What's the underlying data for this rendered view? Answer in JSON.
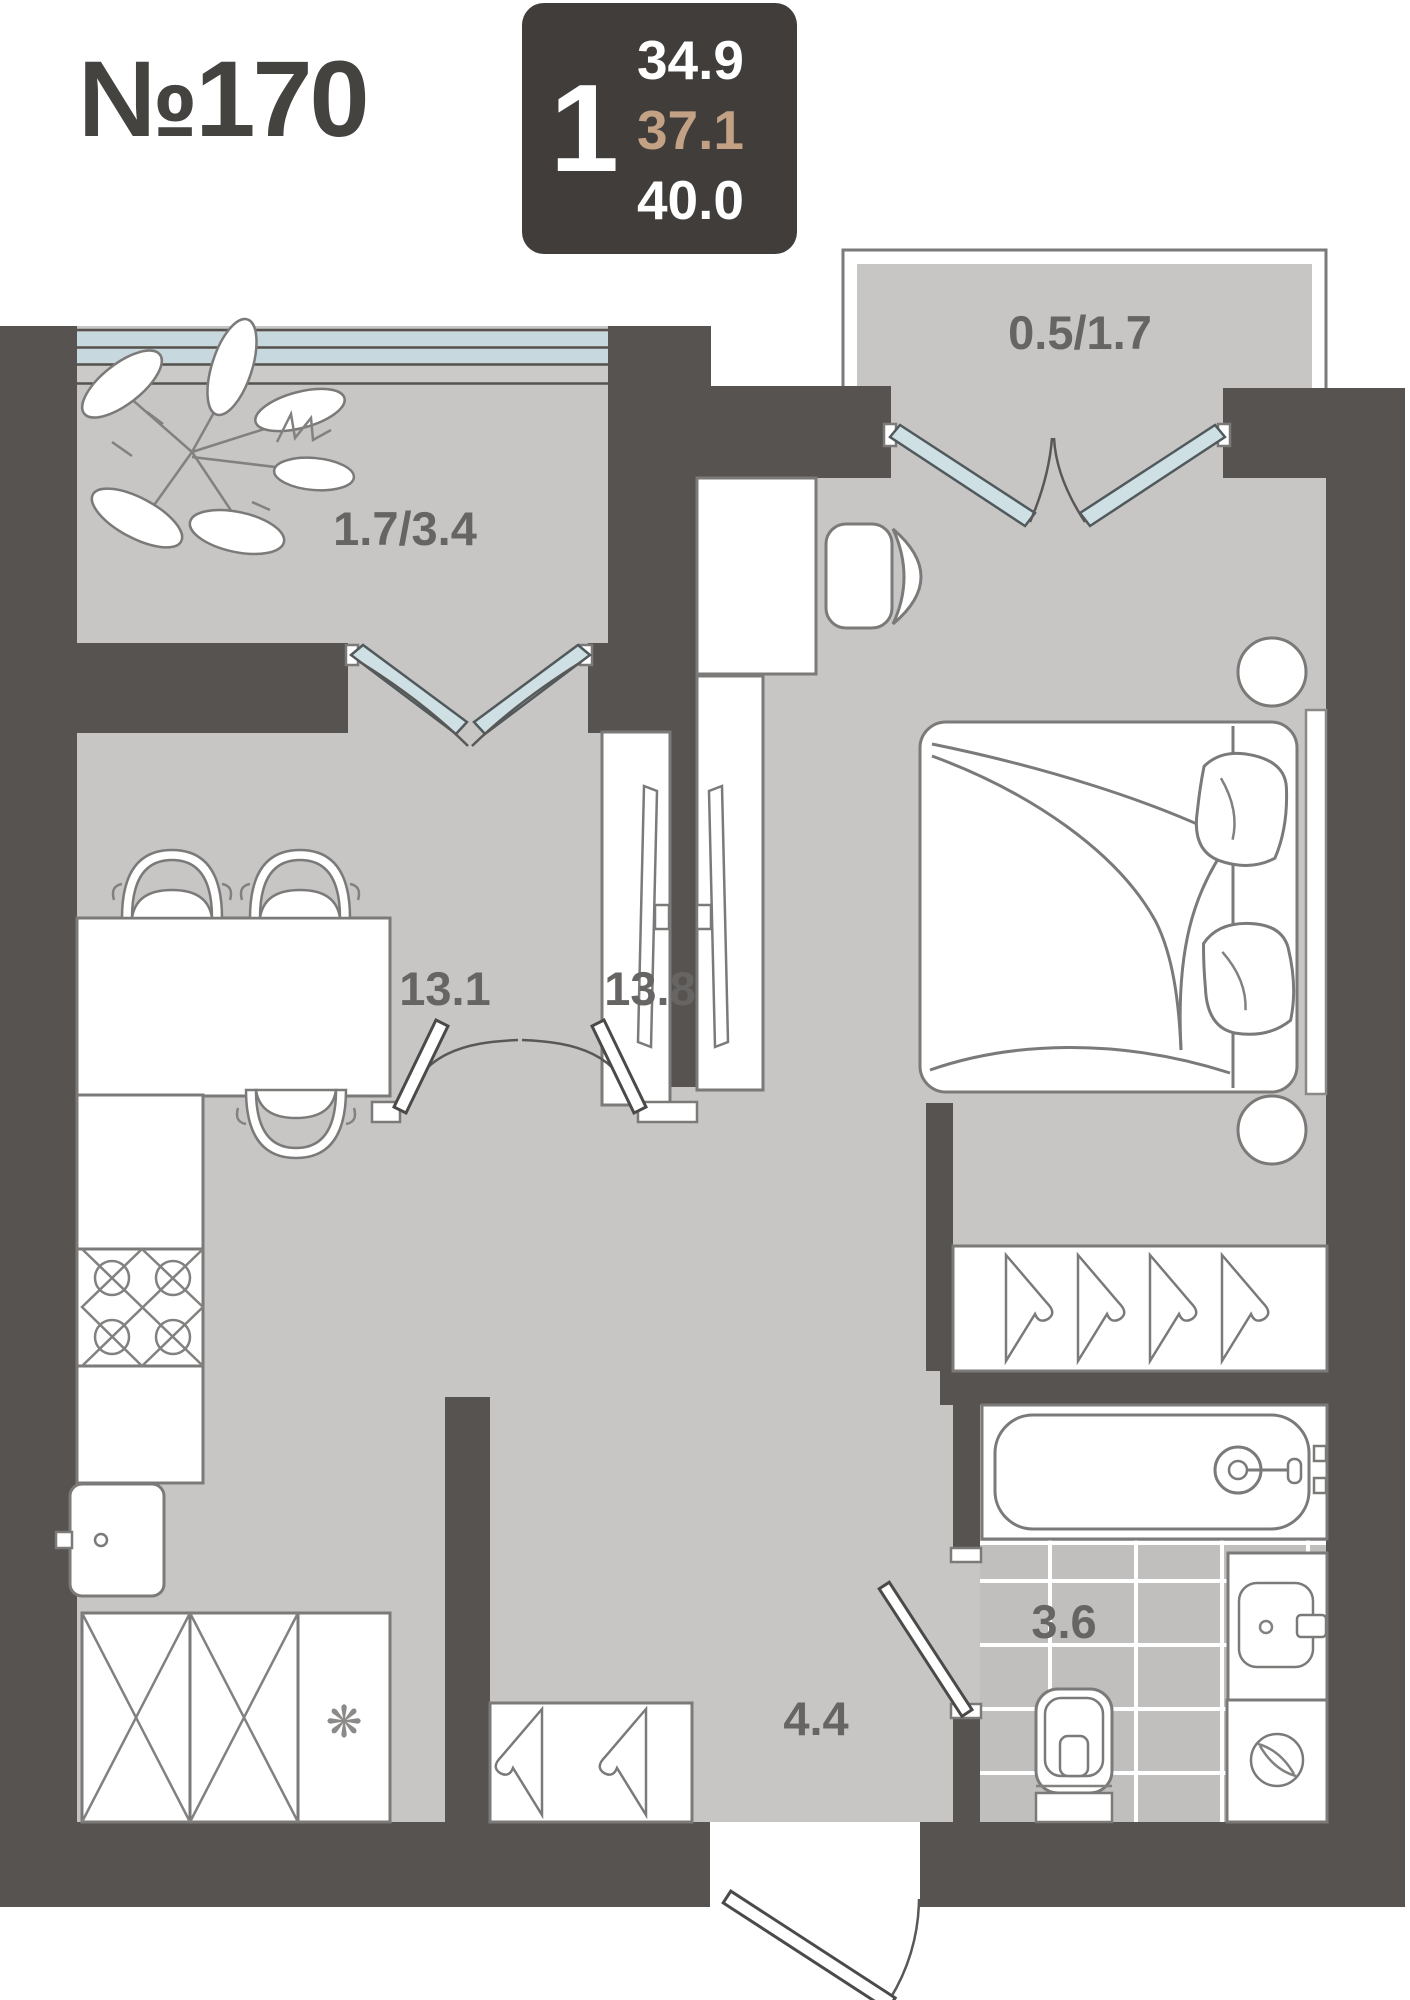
{
  "header": {
    "apartment_number": "№170",
    "badge": {
      "rooms_count": "1",
      "area_living": "34.9",
      "area_planned": "37.1",
      "area_total": "40.0"
    }
  },
  "plan": {
    "labels": {
      "balcony_left": "1.7/3.4",
      "balcony_right": "0.5/1.7",
      "kitchen_living": "13.1",
      "bedroom": "13.8",
      "bathroom": "3.6",
      "hallway": "4.4"
    },
    "snowflake_symbol": "❋"
  },
  "colors": {
    "badge_background": "#403D3B",
    "area_accent": "#C2A184",
    "title_text": "#454340",
    "wall": "#575350",
    "floor": "#C8C6C5",
    "door_glass": "#CFE0E5",
    "bath_tile": "#C1BFBE",
    "label_text": "#676563"
  }
}
